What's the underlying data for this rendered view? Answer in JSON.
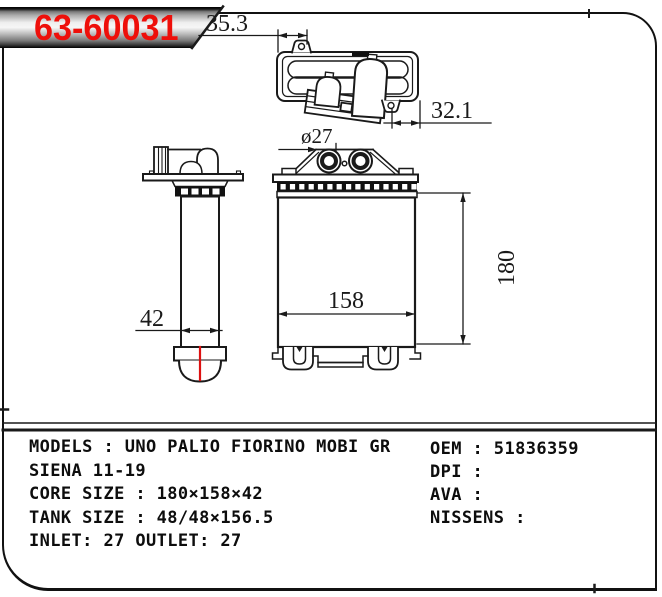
{
  "part_number": "63-60031",
  "drawing": {
    "dimensions": {
      "tank_top_width": "35.3",
      "tank_top_offset": "32.1",
      "pipe_diameter": "ø27",
      "core_width": "158",
      "core_height": "180",
      "core_depth": "42"
    }
  },
  "specs": {
    "left": [
      "MODELS : UNO PALIO FIORINO MOBI GR",
      "SIENA 11-19",
      "CORE SIZE : 180×158×42",
      "TANK SIZE : 48/48×156.5",
      "INLET: 27 OUTLET: 27"
    ],
    "right": [
      "OEM : 51836359",
      "DPI :",
      "AVA :",
      "NISSENS :"
    ]
  },
  "colors": {
    "part_number_red": "#ee0f0a",
    "marker_red": "#dd1111",
    "line_black": "#1a1a1a"
  }
}
